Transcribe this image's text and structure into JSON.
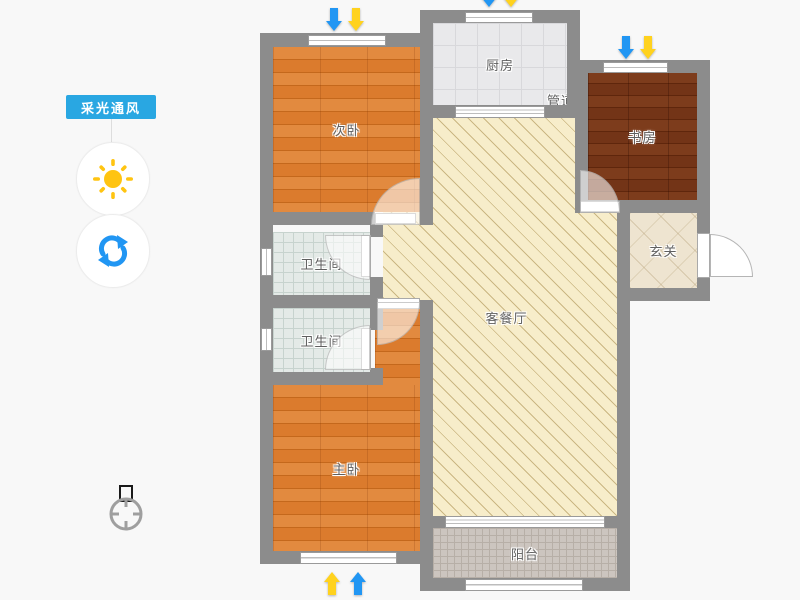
{
  "app": {
    "view": "apartment-floor-plan"
  },
  "sidebar": {
    "badge": "采光通风",
    "buttons": [
      {
        "icon": "sun-icon",
        "color": "#ffc411"
      },
      {
        "icon": "refresh-icon",
        "color": "#2196f3"
      }
    ]
  },
  "compass": {
    "icon": "compass-north-icon"
  },
  "rooms": [
    {
      "id": "secondary-bedroom",
      "label": "次卧",
      "floor": "orange-wood"
    },
    {
      "id": "kitchen",
      "label": "厨房",
      "floor": "gray-tile"
    },
    {
      "id": "duct",
      "label": "管道",
      "floor": "shaft"
    },
    {
      "id": "study",
      "label": "书房",
      "floor": "dark-wood"
    },
    {
      "id": "entry",
      "label": "玄关",
      "floor": "marble-tile"
    },
    {
      "id": "bathroom-1",
      "label": "卫生间",
      "floor": "small-tile"
    },
    {
      "id": "bathroom-2",
      "label": "卫生间",
      "floor": "small-tile"
    },
    {
      "id": "living-dining",
      "label": "客餐厅",
      "floor": "hatched"
    },
    {
      "id": "master-bedroom",
      "label": "主卧",
      "floor": "orange-wood"
    },
    {
      "id": "balcony",
      "label": "阳台",
      "floor": "mosaic-tile"
    }
  ],
  "indicators": {
    "light_arrow_color": "#ffd21e",
    "wind_arrow_color": "#2196f3"
  },
  "colors": {
    "accent_blue": "#29a7e2",
    "wall_gray": "#8c8c8c",
    "background": "#f8f8f8",
    "label_text": "#5f5f5f"
  }
}
